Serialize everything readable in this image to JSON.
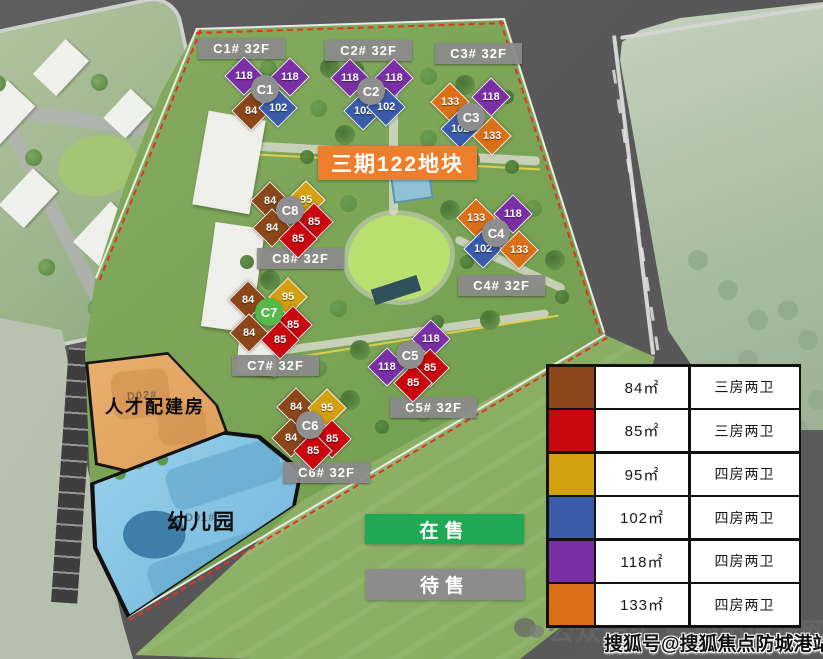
{
  "banner": {
    "label": "三期122地块",
    "bg": "#EF7E2C"
  },
  "status_legend": [
    {
      "label": "在售",
      "color": "#21A853"
    },
    {
      "label": "待售",
      "color": "#8C8C8C"
    }
  ],
  "plot_labels": {
    "talent_housing": "人才配建房",
    "kindergarten": "幼儿园",
    "talent_sub": "D02#",
    "kinder_sub": "D01#"
  },
  "unit_types": {
    "84": {
      "color": "#8B4719"
    },
    "85": {
      "color": "#C9070F"
    },
    "95": {
      "color": "#D3A011"
    },
    "102": {
      "color": "#3A5CA8"
    },
    "118": {
      "color": "#7B2FA5"
    },
    "133": {
      "color": "#DB6F17"
    }
  },
  "legend_table": {
    "rows": [
      {
        "key": "84",
        "size": "84㎡",
        "rooms": "三房两卫"
      },
      {
        "key": "85",
        "size": "85㎡",
        "rooms": "三房两卫"
      },
      {
        "key": "95",
        "size": "95㎡",
        "rooms": "四房两卫"
      },
      {
        "key": "102",
        "size": "102㎡",
        "rooms": "四房两卫"
      },
      {
        "key": "118",
        "size": "118㎡",
        "rooms": "四房两卫"
      },
      {
        "key": "133",
        "size": "133㎡",
        "rooms": "四房两卫"
      }
    ]
  },
  "buildings": [
    {
      "id": "C1",
      "floors_label": "C1# 32F",
      "status": "pending",
      "label_x": 198,
      "label_y": 38,
      "circle_x": 265,
      "circle_y": 89,
      "units": [
        {
          "t": "118",
          "x": 243,
          "y": 75
        },
        {
          "t": "118",
          "x": 289,
          "y": 76
        },
        {
          "t": "84",
          "x": 250,
          "y": 110
        },
        {
          "t": "102",
          "x": 277,
          "y": 107
        }
      ]
    },
    {
      "id": "C2",
      "floors_label": "C2# 32F",
      "status": "pending",
      "label_x": 325,
      "label_y": 40,
      "circle_x": 371,
      "circle_y": 91,
      "units": [
        {
          "t": "118",
          "x": 349,
          "y": 77
        },
        {
          "t": "118",
          "x": 393,
          "y": 77
        },
        {
          "t": "102",
          "x": 362,
          "y": 110
        },
        {
          "t": "102",
          "x": 385,
          "y": 106
        }
      ]
    },
    {
      "id": "C3",
      "floors_label": "C3# 32F",
      "status": "pending",
      "label_x": 435,
      "label_y": 43,
      "circle_x": 471,
      "circle_y": 117,
      "units": [
        {
          "t": "133",
          "x": 449,
          "y": 101
        },
        {
          "t": "118",
          "x": 490,
          "y": 96
        },
        {
          "t": "102",
          "x": 459,
          "y": 128
        },
        {
          "t": "133",
          "x": 491,
          "y": 135
        }
      ]
    },
    {
      "id": "C8",
      "floors_label": "C8# 32F",
      "status": "pending",
      "label_x": 257,
      "label_y": 248,
      "circle_x": 290,
      "circle_y": 210,
      "units": [
        {
          "t": "84",
          "x": 269,
          "y": 200
        },
        {
          "t": "95",
          "x": 305,
          "y": 199
        },
        {
          "t": "85",
          "x": 313,
          "y": 221
        },
        {
          "t": "84",
          "x": 271,
          "y": 227
        },
        {
          "t": "85",
          "x": 297,
          "y": 238
        }
      ]
    },
    {
      "id": "C4",
      "floors_label": "C4# 32F",
      "status": "pending",
      "label_x": 458,
      "label_y": 275,
      "circle_x": 496,
      "circle_y": 233,
      "units": [
        {
          "t": "133",
          "x": 475,
          "y": 217
        },
        {
          "t": "118",
          "x": 512,
          "y": 213
        },
        {
          "t": "102",
          "x": 482,
          "y": 248
        },
        {
          "t": "133",
          "x": 518,
          "y": 249
        }
      ]
    },
    {
      "id": "C7",
      "floors_label": "C7# 32F",
      "status": "onsale",
      "label_x": 232,
      "label_y": 355,
      "circle_x": 269,
      "circle_y": 312,
      "units": [
        {
          "t": "84",
          "x": 247,
          "y": 299
        },
        {
          "t": "95",
          "x": 287,
          "y": 296
        },
        {
          "t": "85",
          "x": 292,
          "y": 324
        },
        {
          "t": "84",
          "x": 248,
          "y": 332
        },
        {
          "t": "85",
          "x": 279,
          "y": 339
        }
      ]
    },
    {
      "id": "C5",
      "floors_label": "C5# 32F",
      "status": "pending",
      "label_x": 390,
      "label_y": 397,
      "circle_x": 410,
      "circle_y": 355,
      "units": [
        {
          "t": "118",
          "x": 430,
          "y": 338
        },
        {
          "t": "118",
          "x": 386,
          "y": 366
        },
        {
          "t": "85",
          "x": 429,
          "y": 367
        },
        {
          "t": "85",
          "x": 412,
          "y": 382
        }
      ]
    },
    {
      "id": "C6",
      "floors_label": "C6# 32F",
      "status": "pending",
      "label_x": 283,
      "label_y": 462,
      "circle_x": 310,
      "circle_y": 425,
      "units": [
        {
          "t": "84",
          "x": 295,
          "y": 406
        },
        {
          "t": "95",
          "x": 326,
          "y": 407
        },
        {
          "t": "84",
          "x": 290,
          "y": 437
        },
        {
          "t": "85",
          "x": 331,
          "y": 438
        },
        {
          "t": "85",
          "x": 312,
          "y": 450
        }
      ]
    }
  ],
  "watermarks": {
    "wechat_account": "公众号:广州楼市情报网",
    "sohu_account": "搜狐号@搜狐焦点防城港站"
  }
}
